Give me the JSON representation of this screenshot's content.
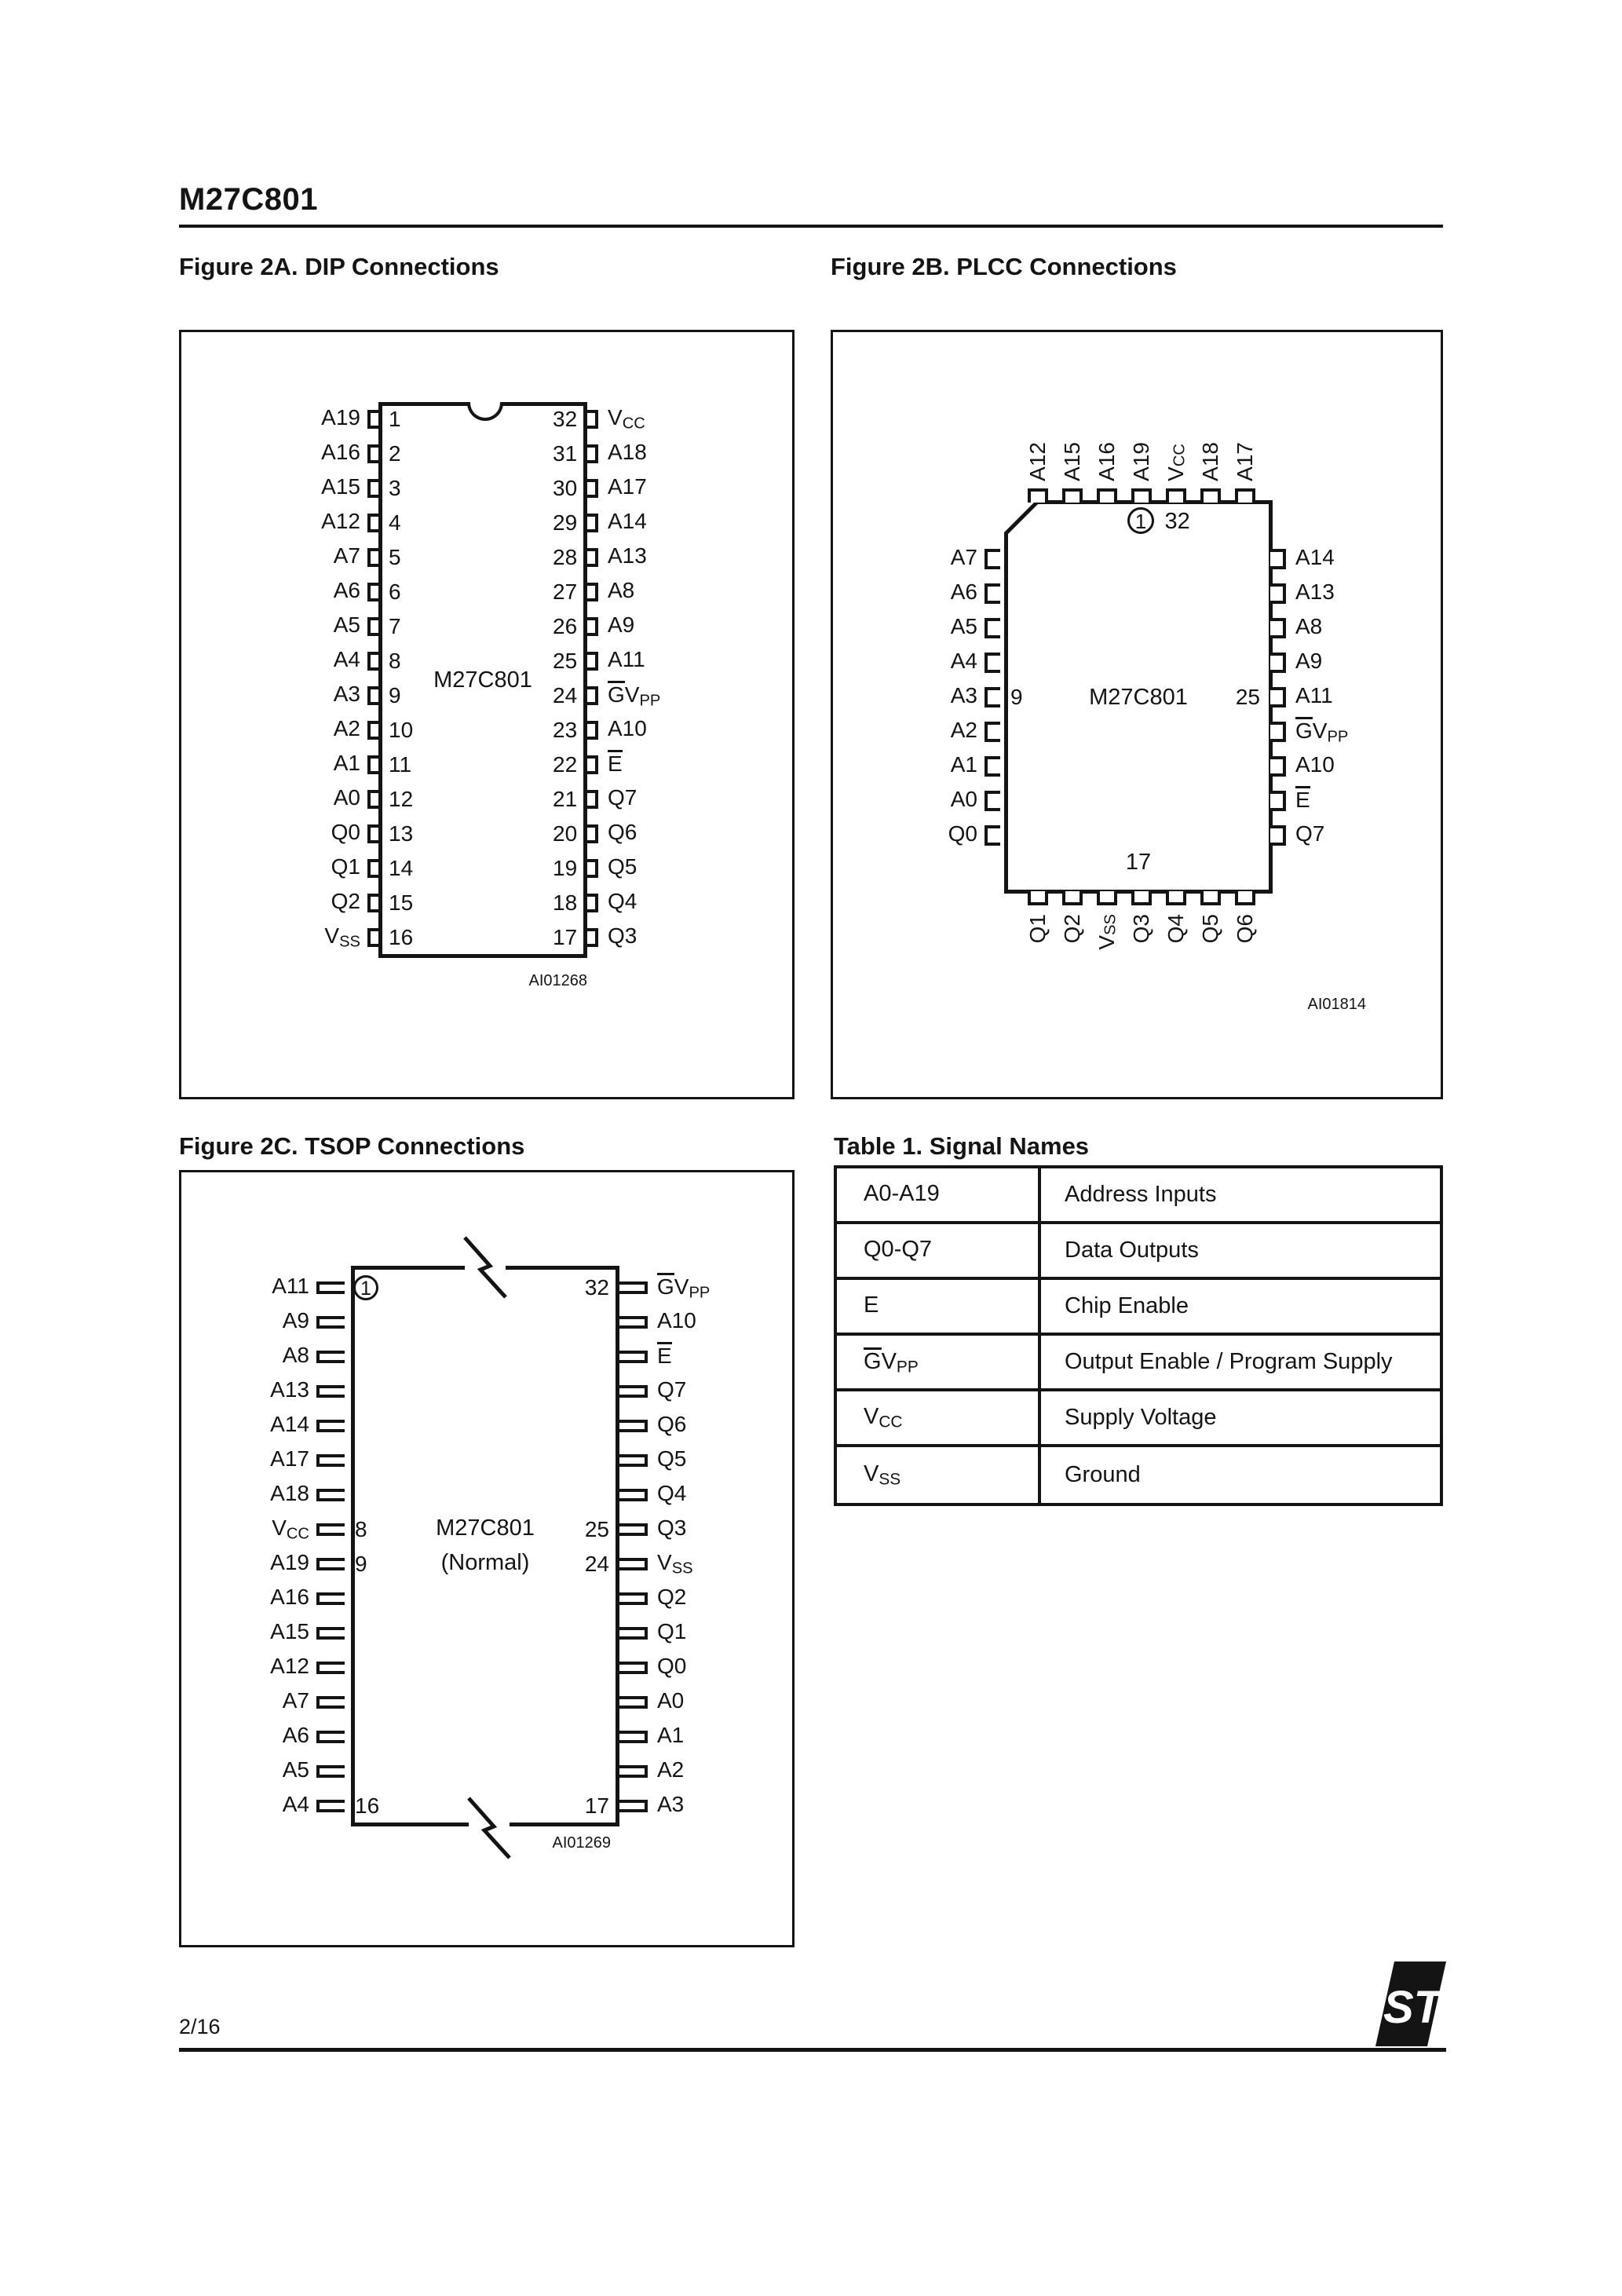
{
  "header": {
    "title": "M27C801"
  },
  "footer": {
    "page": "2/16",
    "logo_text": "ST"
  },
  "figures": {
    "dip": {
      "title": "Figure 2A. DIP Connections",
      "chip_label": "M27C801",
      "figure_code": "AI01268",
      "left_pins": [
        {
          "label": {
            "pre": "A19"
          },
          "num": "1"
        },
        {
          "label": {
            "pre": "A16"
          },
          "num": "2"
        },
        {
          "label": {
            "pre": "A15"
          },
          "num": "3"
        },
        {
          "label": {
            "pre": "A12"
          },
          "num": "4"
        },
        {
          "label": {
            "pre": "A7"
          },
          "num": "5"
        },
        {
          "label": {
            "pre": "A6"
          },
          "num": "6"
        },
        {
          "label": {
            "pre": "A5"
          },
          "num": "7"
        },
        {
          "label": {
            "pre": "A4"
          },
          "num": "8"
        },
        {
          "label": {
            "pre": "A3"
          },
          "num": "9"
        },
        {
          "label": {
            "pre": "A2"
          },
          "num": "10"
        },
        {
          "label": {
            "pre": "A1"
          },
          "num": "11"
        },
        {
          "label": {
            "pre": "A0"
          },
          "num": "12"
        },
        {
          "label": {
            "pre": "Q0"
          },
          "num": "13"
        },
        {
          "label": {
            "pre": "Q1"
          },
          "num": "14"
        },
        {
          "label": {
            "pre": "Q2"
          },
          "num": "15"
        },
        {
          "label": {
            "pre": "V",
            "sub": "SS"
          },
          "num": "16"
        }
      ],
      "right_pins": [
        {
          "num": "32",
          "label": {
            "pre": "V",
            "sub": "CC"
          }
        },
        {
          "num": "31",
          "label": {
            "pre": "A18"
          }
        },
        {
          "num": "30",
          "label": {
            "pre": "A17"
          }
        },
        {
          "num": "29",
          "label": {
            "pre": "A14"
          }
        },
        {
          "num": "28",
          "label": {
            "pre": "A13"
          }
        },
        {
          "num": "27",
          "label": {
            "pre": "A8"
          }
        },
        {
          "num": "26",
          "label": {
            "pre": "A9"
          }
        },
        {
          "num": "25",
          "label": {
            "pre": "A11"
          }
        },
        {
          "num": "24",
          "label": {
            "over": "G",
            "pre": "V",
            "sub": "PP"
          }
        },
        {
          "num": "23",
          "label": {
            "pre": "A10"
          }
        },
        {
          "num": "22",
          "label": {
            "over": "E"
          }
        },
        {
          "num": "21",
          "label": {
            "pre": "Q7"
          }
        },
        {
          "num": "20",
          "label": {
            "pre": "Q6"
          }
        },
        {
          "num": "19",
          "label": {
            "pre": "Q5"
          }
        },
        {
          "num": "18",
          "label": {
            "pre": "Q4"
          }
        },
        {
          "num": "17",
          "label": {
            "pre": "Q3"
          }
        }
      ]
    },
    "plcc": {
      "title": "Figure 2B. PLCC Connections",
      "chip_label": "M27C801",
      "figure_code": "AI01814",
      "pin1_marker": "1",
      "pin1_adjacent": "32",
      "bottom_marker": "17",
      "top_pins": [
        {
          "label": {
            "pre": "A12"
          }
        },
        {
          "label": {
            "pre": "A15"
          }
        },
        {
          "label": {
            "pre": "A16"
          }
        },
        {
          "label": {
            "pre": "A19"
          }
        },
        {
          "label": {
            "pre": "V",
            "sub": "CC"
          }
        },
        {
          "label": {
            "pre": "A18"
          }
        },
        {
          "label": {
            "pre": "A17"
          }
        }
      ],
      "left_pins": [
        {
          "label": {
            "pre": "A7"
          }
        },
        {
          "label": {
            "pre": "A6"
          }
        },
        {
          "label": {
            "pre": "A5"
          }
        },
        {
          "label": {
            "pre": "A4"
          }
        },
        {
          "label": {
            "pre": "A3"
          },
          "num": "9"
        },
        {
          "label": {
            "pre": "A2"
          }
        },
        {
          "label": {
            "pre": "A1"
          }
        },
        {
          "label": {
            "pre": "A0"
          }
        },
        {
          "label": {
            "pre": "Q0"
          }
        }
      ],
      "right_pins": [
        {
          "label": {
            "pre": "A14"
          }
        },
        {
          "label": {
            "pre": "A13"
          }
        },
        {
          "label": {
            "pre": "A8"
          }
        },
        {
          "label": {
            "pre": "A9"
          }
        },
        {
          "label": {
            "pre": "A11"
          },
          "num": "25"
        },
        {
          "label": {
            "over": "G",
            "pre": "V",
            "sub": "PP"
          }
        },
        {
          "label": {
            "pre": "A10"
          }
        },
        {
          "label": {
            "over": "E"
          }
        },
        {
          "label": {
            "pre": "Q7"
          }
        }
      ],
      "bottom_pins": [
        {
          "label": {
            "pre": "Q1"
          }
        },
        {
          "label": {
            "pre": "Q2"
          }
        },
        {
          "label": {
            "pre": "V",
            "sub": "SS"
          }
        },
        {
          "label": {
            "pre": "Q3"
          }
        },
        {
          "label": {
            "pre": "Q4"
          }
        },
        {
          "label": {
            "pre": "Q5"
          }
        },
        {
          "label": {
            "pre": "Q6"
          }
        }
      ]
    },
    "tsop": {
      "title": "Figure 2C. TSOP Connections",
      "chip_label_line1": "M27C801",
      "chip_label_line2": "(Normal)",
      "figure_code": "AI01269",
      "left_pins": [
        {
          "label": {
            "pre": "A11"
          },
          "num": "1",
          "circled": true
        },
        {
          "label": {
            "pre": "A9"
          }
        },
        {
          "label": {
            "pre": "A8"
          }
        },
        {
          "label": {
            "pre": "A13"
          }
        },
        {
          "label": {
            "pre": "A14"
          }
        },
        {
          "label": {
            "pre": "A17"
          }
        },
        {
          "label": {
            "pre": "A18"
          }
        },
        {
          "label": {
            "pre": "V",
            "sub": "CC"
          },
          "num": "8"
        },
        {
          "label": {
            "pre": "A19"
          },
          "num": "9"
        },
        {
          "label": {
            "pre": "A16"
          }
        },
        {
          "label": {
            "pre": "A15"
          }
        },
        {
          "label": {
            "pre": "A12"
          }
        },
        {
          "label": {
            "pre": "A7"
          }
        },
        {
          "label": {
            "pre": "A6"
          }
        },
        {
          "label": {
            "pre": "A5"
          }
        },
        {
          "label": {
            "pre": "A4"
          },
          "num": "16"
        }
      ],
      "right_pins": [
        {
          "num": "32",
          "label": {
            "over": "G",
            "pre": "V",
            "sub": "PP"
          }
        },
        {
          "label": {
            "pre": "A10"
          }
        },
        {
          "label": {
            "over": "E"
          }
        },
        {
          "label": {
            "pre": "Q7"
          }
        },
        {
          "label": {
            "pre": "Q6"
          }
        },
        {
          "label": {
            "pre": "Q5"
          }
        },
        {
          "label": {
            "pre": "Q4"
          }
        },
        {
          "num": "25",
          "label": {
            "pre": "Q3"
          }
        },
        {
          "num": "24",
          "label": {
            "pre": "V",
            "sub": "SS"
          }
        },
        {
          "label": {
            "pre": "Q2"
          }
        },
        {
          "label": {
            "pre": "Q1"
          }
        },
        {
          "label": {
            "pre": "Q0"
          }
        },
        {
          "label": {
            "pre": "A0"
          }
        },
        {
          "label": {
            "pre": "A1"
          }
        },
        {
          "label": {
            "pre": "A2"
          }
        },
        {
          "num": "17",
          "label": {
            "pre": "A3"
          }
        }
      ]
    }
  },
  "table": {
    "title": "Table 1. Signal Names",
    "rows": [
      {
        "signal": {
          "pre": "A0-A19"
        },
        "description": "Address Inputs"
      },
      {
        "signal": {
          "pre": "Q0-Q7"
        },
        "description": "Data Outputs"
      },
      {
        "signal": {
          "pre": "E"
        },
        "description": "Chip Enable"
      },
      {
        "signal": {
          "over": "G",
          "pre": "V",
          "sub": "PP"
        },
        "description": "Output Enable / Program Supply"
      },
      {
        "signal": {
          "pre": "V",
          "sub": "CC"
        },
        "description": "Supply Voltage"
      },
      {
        "signal": {
          "pre": "V",
          "sub": "SS"
        },
        "description": "Ground"
      }
    ]
  }
}
